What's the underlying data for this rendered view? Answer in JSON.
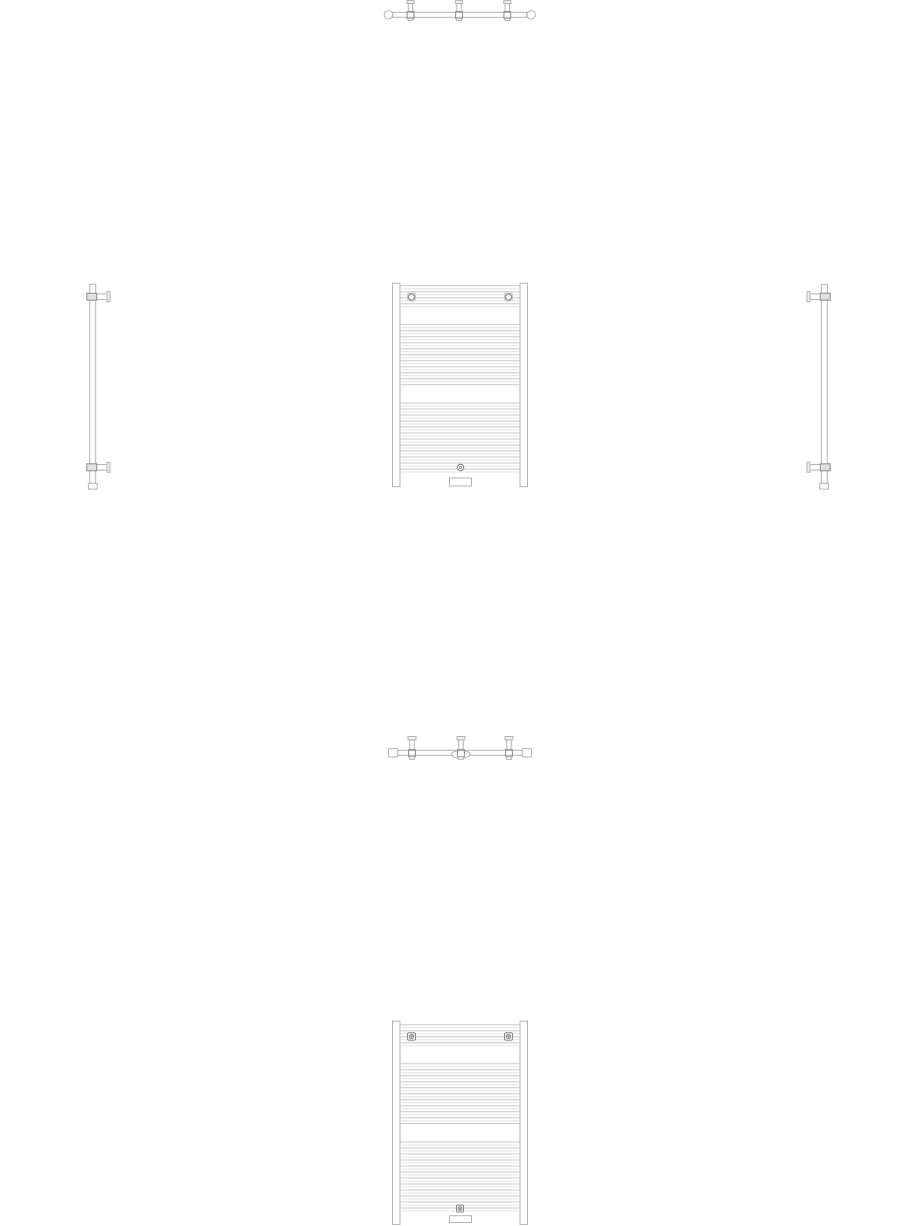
{
  "document": {
    "background": "#ffffff",
    "description": "Multi-view CAD line drawing of a bathroom towel-rail radiator: top plan view, front elevation, left and right side elevations, bottom plan view, and a second front elevation variant. No text labels or dimensions are shown."
  },
  "colors": {
    "outline": "#b3b3b3",
    "dark": "#8c8c8c",
    "tube_dark": "#c9c9c9",
    "tube_light": "#e3e3e3",
    "fill": "#ffffff",
    "fill_gray": "#e0e0e0",
    "fill_light": "#f0f0f0"
  },
  "views": {
    "top_view_1": {
      "x": 384,
      "y": 0,
      "w": 152,
      "h": 24,
      "primitives": [
        {
          "t": "rect",
          "x": 8.7,
          "y": 12.3,
          "w": 134,
          "h": 5,
          "s": "outline",
          "f": "fill"
        },
        {
          "t": "circle",
          "cx": 4.4,
          "cy": 14.8,
          "r": 4.2,
          "s": "outline",
          "f": "fill"
        },
        {
          "t": "circle",
          "cx": 147.2,
          "cy": 14.8,
          "r": 4.2,
          "s": "outline",
          "f": "fill"
        },
        {
          "t": "rect",
          "x": 22.9,
          "y": 0.6,
          "w": 7.2,
          "h": 3,
          "s": "outline",
          "f": "fill_light"
        },
        {
          "t": "rect",
          "x": 24.3,
          "y": 3.6,
          "w": 4.4,
          "h": 8.7,
          "s": "outline",
          "f": "fill"
        },
        {
          "t": "rect",
          "x": 23.1,
          "y": 11.6,
          "w": 6.8,
          "h": 7,
          "s": "dark"
        },
        {
          "t": "rect",
          "x": 24.1,
          "y": 18.6,
          "w": 4.8,
          "h": 1.9,
          "s": "outline",
          "f": "fill"
        },
        {
          "t": "rect",
          "x": 71.4,
          "y": 0.6,
          "w": 7.2,
          "h": 3,
          "s": "outline",
          "f": "fill_light"
        },
        {
          "t": "rect",
          "x": 72.8,
          "y": 3.6,
          "w": 4.4,
          "h": 8.7,
          "s": "outline",
          "f": "fill"
        },
        {
          "t": "rect",
          "x": 71.6,
          "y": 11.6,
          "w": 6.8,
          "h": 7,
          "s": "dark"
        },
        {
          "t": "rect",
          "x": 72.6,
          "y": 18.6,
          "w": 4.8,
          "h": 1.9,
          "s": "outline",
          "f": "fill"
        },
        {
          "t": "rect",
          "x": 119.7,
          "y": 0.6,
          "w": 7.2,
          "h": 3,
          "s": "outline",
          "f": "fill_light"
        },
        {
          "t": "rect",
          "x": 121.1,
          "y": 3.6,
          "w": 4.4,
          "h": 8.7,
          "s": "outline",
          "f": "fill"
        },
        {
          "t": "rect",
          "x": 119.9,
          "y": 11.6,
          "w": 6.8,
          "h": 7,
          "s": "dark"
        },
        {
          "t": "rect",
          "x": 120.9,
          "y": 18.6,
          "w": 4.8,
          "h": 1.9,
          "s": "outline",
          "f": "fill"
        }
      ]
    },
    "side_view_left": {
      "x": 85,
      "y": 284,
      "w": 26,
      "h": 206,
      "primitives": [
        {
          "t": "rect",
          "x": 4.7,
          "y": 0.3,
          "w": 6,
          "h": 199,
          "s": "outline",
          "f": "fill"
        },
        {
          "t": "rect",
          "x": 10.7,
          "y": 9.9,
          "w": 11.3,
          "h": 5.6,
          "s": "outline",
          "f": "fill"
        },
        {
          "t": "rect",
          "x": 22,
          "y": 7.7,
          "w": 3,
          "h": 10,
          "s": "outline",
          "f": "fill_light"
        },
        {
          "t": "rect",
          "x": 1.8,
          "y": 9.2,
          "w": 9.9,
          "h": 7,
          "s": "dark",
          "f": "fill_gray"
        },
        {
          "t": "rect",
          "x": 10.7,
          "y": 180.5,
          "w": 11.3,
          "h": 5.6,
          "s": "outline",
          "f": "fill"
        },
        {
          "t": "rect",
          "x": 22,
          "y": 178.3,
          "w": 3,
          "h": 10,
          "s": "outline",
          "f": "fill_light"
        },
        {
          "t": "rect",
          "x": 1.8,
          "y": 179.8,
          "w": 9.9,
          "h": 7,
          "s": "dark",
          "f": "fill_gray"
        },
        {
          "t": "rect",
          "x": 3.4,
          "y": 199.3,
          "w": 8.8,
          "h": 5.8,
          "s": "outline",
          "f": "fill"
        }
      ]
    },
    "front_view_1": {
      "x": 392,
      "y": 283,
      "w": 136,
      "h": 204,
      "primitives": [
        {
          "t": "rect",
          "x": 0.5,
          "y": 0.2,
          "w": 7.5,
          "h": 203.5,
          "s": "outline",
          "f": "fill"
        },
        {
          "t": "rect",
          "x": 128,
          "y": 0.2,
          "w": 7.5,
          "h": 203.5,
          "s": "outline",
          "f": "fill"
        },
        {
          "t": "hlines",
          "x1": 8,
          "x2": 128,
          "y0": 2.7,
          "dy": 3,
          "n": 8,
          "cycle": [
            "tube_dark",
            "tube_light"
          ]
        },
        {
          "t": "hlines",
          "x1": 8,
          "x2": 128,
          "y0": 41.7,
          "dy": 3,
          "n": 21,
          "cycle": [
            "tube_dark",
            "tube_light"
          ]
        },
        {
          "t": "hlines",
          "x1": 8,
          "x2": 128,
          "y0": 120,
          "dy": 3,
          "n": 24,
          "cycle": [
            "tube_dark",
            "tube_light"
          ]
        },
        {
          "t": "rect",
          "x": 15.7,
          "y": 10.2,
          "w": 7.6,
          "h": 7.6,
          "s": "tube_dark",
          "f": "fill"
        },
        {
          "t": "circle",
          "cx": 19.5,
          "cy": 14,
          "r": 3.1,
          "s": "dark",
          "sw": 1.3,
          "f": "fill"
        },
        {
          "t": "rect",
          "x": 112.7,
          "y": 10.2,
          "w": 7.6,
          "h": 7.6,
          "s": "tube_dark",
          "f": "fill"
        },
        {
          "t": "circle",
          "cx": 116.5,
          "cy": 14,
          "r": 3.1,
          "s": "dark",
          "sw": 1.3,
          "f": "fill"
        },
        {
          "t": "circle",
          "cx": 68.5,
          "cy": 184.5,
          "r": 3.2,
          "s": "dark",
          "sw": 1.2,
          "f": "fill"
        },
        {
          "t": "circle",
          "cx": 68.5,
          "cy": 184.5,
          "r": 1.2,
          "s": "dark",
          "sw": 0.8
        },
        {
          "t": "rect",
          "x": 57.5,
          "y": 195,
          "w": 22,
          "h": 8,
          "s": "outline",
          "f": "fill"
        }
      ]
    },
    "side_view_right": {
      "x": 806,
      "y": 284,
      "w": 26,
      "h": 206,
      "primitives": [
        {
          "t": "rect",
          "x": 15.3,
          "y": 0.3,
          "w": 6,
          "h": 199,
          "s": "outline",
          "f": "fill"
        },
        {
          "t": "rect",
          "x": 4,
          "y": 9.9,
          "w": 11.3,
          "h": 5.6,
          "s": "outline",
          "f": "fill"
        },
        {
          "t": "rect",
          "x": 1,
          "y": 7.7,
          "w": 3,
          "h": 10,
          "s": "outline",
          "f": "fill_light"
        },
        {
          "t": "rect",
          "x": 14.3,
          "y": 9.2,
          "w": 9.9,
          "h": 7,
          "s": "dark",
          "f": "fill_gray"
        },
        {
          "t": "rect",
          "x": 4,
          "y": 180.5,
          "w": 11.3,
          "h": 5.6,
          "s": "outline",
          "f": "fill"
        },
        {
          "t": "rect",
          "x": 1,
          "y": 178.3,
          "w": 3,
          "h": 10,
          "s": "outline",
          "f": "fill_light"
        },
        {
          "t": "rect",
          "x": 14.3,
          "y": 179.8,
          "w": 9.9,
          "h": 7,
          "s": "dark",
          "f": "fill_gray"
        },
        {
          "t": "rect",
          "x": 13.8,
          "y": 199.3,
          "w": 8.8,
          "h": 5.8,
          "s": "outline",
          "f": "fill"
        }
      ]
    },
    "top_view_2": {
      "x": 388,
      "y": 736,
      "w": 146,
      "h": 27,
      "primitives": [
        {
          "t": "rect",
          "x": 4.7,
          "y": 14.3,
          "w": 134.6,
          "h": 5,
          "s": "outline",
          "f": "fill"
        },
        {
          "t": "rect",
          "x": 0.4,
          "y": 12.6,
          "w": 9.4,
          "h": 8.4,
          "rx": 1.5,
          "s": "outline",
          "f": "fill"
        },
        {
          "t": "rect",
          "x": 134.2,
          "y": 12.6,
          "w": 9.4,
          "h": 8.4,
          "rx": 1.5,
          "s": "outline",
          "f": "fill"
        },
        {
          "t": "ellipse",
          "cx": 72.9,
          "cy": 18.4,
          "rx": 9.2,
          "ry": 3.9,
          "s": "outline",
          "f": "fill"
        },
        {
          "t": "rect",
          "x": 20,
          "y": 0.5,
          "w": 8,
          "h": 3.4,
          "s": "outline",
          "f": "fill_light"
        },
        {
          "t": "rect",
          "x": 21.8,
          "y": 3.9,
          "w": 4.4,
          "h": 10.4,
          "s": "outline",
          "f": "fill"
        },
        {
          "t": "rect",
          "x": 20.6,
          "y": 13.7,
          "w": 6.8,
          "h": 7,
          "s": "dark"
        },
        {
          "t": "rect",
          "x": 21.6,
          "y": 20.7,
          "w": 4.8,
          "h": 2.6,
          "s": "outline",
          "f": "fill"
        },
        {
          "t": "rect",
          "x": 69,
          "y": 0.5,
          "w": 8,
          "h": 3.4,
          "s": "outline",
          "f": "fill_light"
        },
        {
          "t": "rect",
          "x": 70.8,
          "y": 3.9,
          "w": 4.4,
          "h": 10.4,
          "s": "outline",
          "f": "fill"
        },
        {
          "t": "rect",
          "x": 69.6,
          "y": 13.7,
          "w": 6.8,
          "h": 7,
          "s": "dark"
        },
        {
          "t": "rect",
          "x": 70.6,
          "y": 20.7,
          "w": 4.8,
          "h": 2.6,
          "s": "outline",
          "f": "fill"
        },
        {
          "t": "rect",
          "x": 117,
          "y": 0.5,
          "w": 8,
          "h": 3.4,
          "s": "outline",
          "f": "fill_light"
        },
        {
          "t": "rect",
          "x": 118.8,
          "y": 3.9,
          "w": 4.4,
          "h": 10.4,
          "s": "outline",
          "f": "fill"
        },
        {
          "t": "rect",
          "x": 117.6,
          "y": 13.7,
          "w": 6.8,
          "h": 7,
          "s": "dark"
        },
        {
          "t": "rect",
          "x": 118.6,
          "y": 20.7,
          "w": 4.8,
          "h": 2.6,
          "s": "outline",
          "f": "fill"
        }
      ]
    },
    "front_view_2": {
      "x": 392,
      "y": 1021,
      "w": 136,
      "h": 205,
      "primitives": [
        {
          "t": "rect",
          "x": 0.5,
          "y": 0.2,
          "w": 7.5,
          "h": 203.5,
          "s": "outline",
          "f": "fill"
        },
        {
          "t": "rect",
          "x": 128,
          "y": 0.2,
          "w": 7.5,
          "h": 203.5,
          "s": "outline",
          "f": "fill"
        },
        {
          "t": "hlines",
          "x1": 8,
          "x2": 128,
          "y0": 3.7,
          "dy": 3,
          "n": 8,
          "cycle": [
            "tube_dark",
            "tube_light"
          ]
        },
        {
          "t": "hlines",
          "x1": 8,
          "x2": 128,
          "y0": 42.7,
          "dy": 3,
          "n": 21,
          "cycle": [
            "tube_dark",
            "tube_light"
          ]
        },
        {
          "t": "hlines",
          "x1": 8,
          "x2": 128,
          "y0": 121,
          "dy": 3,
          "n": 24,
          "cycle": [
            "tube_dark",
            "tube_light"
          ]
        },
        {
          "t": "rect",
          "x": 15.5,
          "y": 11.8,
          "w": 8,
          "h": 7.4,
          "rx": 1.5,
          "s": "dark",
          "f": "fill_light"
        },
        {
          "t": "circle",
          "cx": 19.5,
          "cy": 15.5,
          "r": 2.1,
          "s": "dark",
          "f": "fill"
        },
        {
          "t": "circle",
          "cx": 19.5,
          "cy": 15.5,
          "r": 0.7,
          "s": "dark",
          "f": "dark"
        },
        {
          "t": "rect",
          "x": 112.5,
          "y": 11.8,
          "w": 8,
          "h": 7.4,
          "rx": 1.5,
          "s": "dark",
          "f": "fill_light"
        },
        {
          "t": "circle",
          "cx": 116.5,
          "cy": 15.5,
          "r": 2.1,
          "s": "dark",
          "f": "fill"
        },
        {
          "t": "circle",
          "cx": 116.5,
          "cy": 15.5,
          "r": 0.7,
          "s": "dark",
          "f": "dark"
        },
        {
          "t": "rect",
          "x": 64.5,
          "y": 184,
          "w": 7,
          "h": 7,
          "rx": 1,
          "s": "dark",
          "f": "fill_light"
        },
        {
          "t": "circle",
          "cx": 68,
          "cy": 187.5,
          "r": 1.9,
          "s": "dark",
          "f": "fill"
        },
        {
          "t": "circle",
          "cx": 68,
          "cy": 187.5,
          "r": 0.6,
          "s": "dark",
          "f": "dark"
        },
        {
          "t": "rect",
          "x": 57.5,
          "y": 194.7,
          "w": 22,
          "h": 6.8,
          "s": "outline",
          "f": "fill"
        }
      ]
    }
  }
}
